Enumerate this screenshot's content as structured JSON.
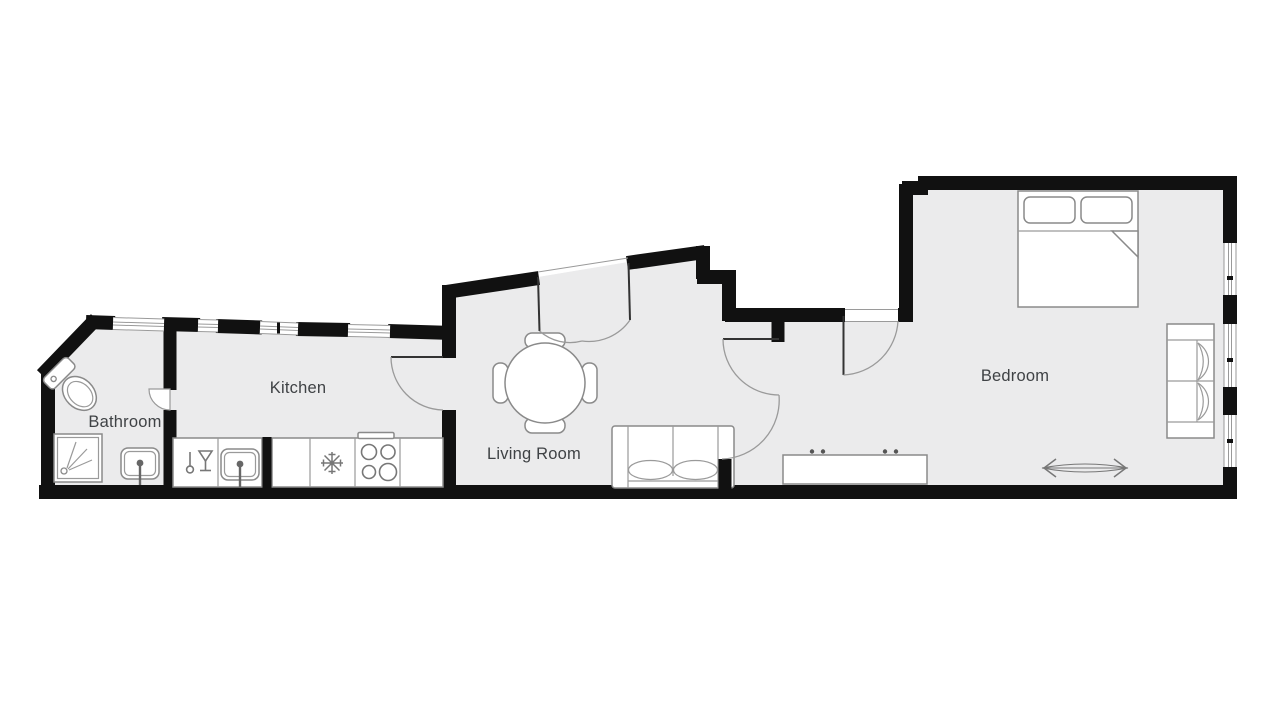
{
  "floorplan": {
    "type": "apartment-floor-plan",
    "colors": {
      "background": "#ffffff",
      "wall": "#111111",
      "floor": "#ebebec",
      "furniture_outline": "#8a8a8a",
      "door_arc": "#9a9a9a",
      "label_text": "#3f4245"
    },
    "rooms": [
      {
        "id": "bathroom",
        "label": "Bathroom",
        "fixtures": [
          "toilet",
          "shower",
          "bathroom-sink",
          "window"
        ]
      },
      {
        "id": "kitchen",
        "label": "Kitchen",
        "fixtures": [
          "counter",
          "dishwasher",
          "kitchen-sink",
          "refrigerator",
          "stove-four-burners",
          "windows",
          "door"
        ]
      },
      {
        "id": "living-room",
        "label": "Living Room",
        "fixtures": [
          "round-dining-table",
          "four-chairs",
          "sofa",
          "double-entry-door",
          "door-to-hall"
        ]
      },
      {
        "id": "bedroom",
        "label": "Bedroom",
        "fixtures": [
          "double-bed",
          "two-pillows",
          "blanket-fold",
          "loveseat",
          "sideboard",
          "radiator",
          "three-windows",
          "bedroom-door",
          "exterior-door"
        ]
      }
    ]
  }
}
